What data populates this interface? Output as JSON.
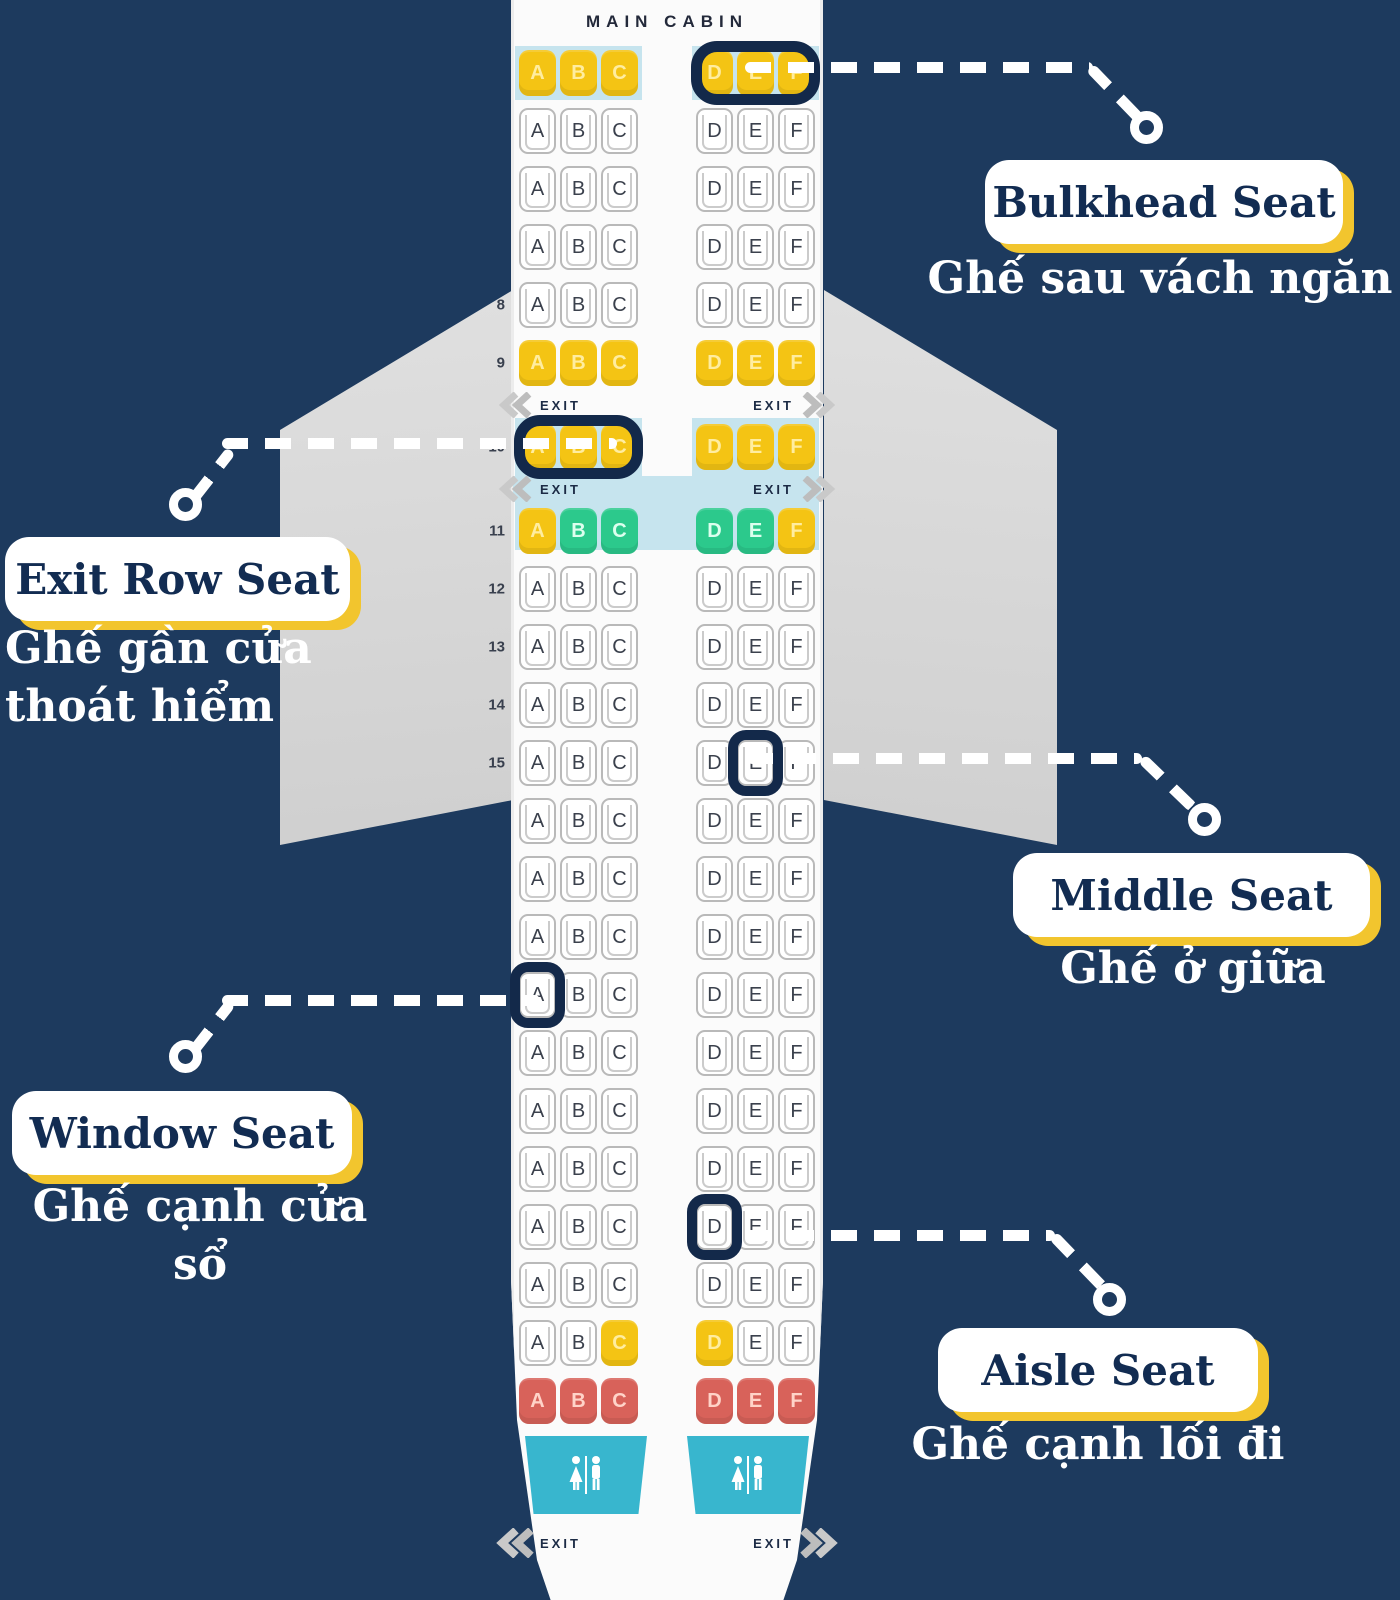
{
  "seatmap": {
    "cabin_label": "MAIN CABIN",
    "exit_label": "EXIT",
    "letters": [
      "A",
      "B",
      "C",
      "D",
      "E",
      "F"
    ],
    "rows": [
      {
        "t": "seats",
        "num": "",
        "c": "yyyyyy",
        "band": "split",
        "ring": "right-group"
      },
      {
        "t": "seats",
        "num": "",
        "c": "wwwwww"
      },
      {
        "t": "seats",
        "num": "",
        "c": "wwwwww"
      },
      {
        "t": "seats",
        "num": "",
        "c": "wwwwww"
      },
      {
        "t": "seats",
        "num": "8",
        "c": "wwwwww"
      },
      {
        "t": "seats",
        "num": "9",
        "c": "yyyyyy"
      },
      {
        "t": "exit"
      },
      {
        "t": "seats",
        "num": "10",
        "c": "yyyyyy",
        "band": "split",
        "ring": "left-group"
      },
      {
        "t": "exit",
        "band": "full"
      },
      {
        "t": "seats",
        "num": "11",
        "c": "yggggy",
        "band": "full"
      },
      {
        "t": "seats",
        "num": "12",
        "c": "wwwwww"
      },
      {
        "t": "seats",
        "num": "13",
        "c": "wwwwww"
      },
      {
        "t": "seats",
        "num": "14",
        "c": "wwwwww"
      },
      {
        "t": "seats",
        "num": "15",
        "c": "wwwwww",
        "ring": 4
      },
      {
        "t": "seats",
        "num": "",
        "c": "wwwwww"
      },
      {
        "t": "seats",
        "num": "",
        "c": "wwwwww"
      },
      {
        "t": "seats",
        "num": "",
        "c": "wwwwww"
      },
      {
        "t": "seats",
        "num": "",
        "c": "wwwwww",
        "ring": 0
      },
      {
        "t": "seats",
        "num": "",
        "c": "wwwwww"
      },
      {
        "t": "seats",
        "num": "",
        "c": "wwwwww"
      },
      {
        "t": "seats",
        "num": "",
        "c": "wwwwww"
      },
      {
        "t": "seats",
        "num": "",
        "c": "wwwwww",
        "ring": 3
      },
      {
        "t": "seats",
        "num": "",
        "c": "wwwwww"
      },
      {
        "t": "seats",
        "num": "",
        "c": "wwyyww"
      },
      {
        "t": "seats",
        "num": "",
        "c": "rrrrrr"
      },
      {
        "t": "lav"
      },
      {
        "t": "exit",
        "bottom": true
      }
    ]
  },
  "callouts": [
    {
      "id": "bulkhead",
      "title": "Bulkhead Seat",
      "subtitle": "Ghế sau vách ngăn"
    },
    {
      "id": "exitrow",
      "title": "Exit Row Seat",
      "subtitle": "Ghế gần cửa thoát hiểm"
    },
    {
      "id": "middle",
      "title": "Middle Seat",
      "subtitle": "Ghế ở giữa"
    },
    {
      "id": "window",
      "title": "Window Seat",
      "subtitle": "Ghế cạnh cửa sổ"
    },
    {
      "id": "aisle",
      "title": "Aisle Seat",
      "subtitle": "Ghế cạnh lối đi"
    }
  ],
  "colors": {
    "background": "#1d3a5e",
    "fuselage": "#fbfbfb",
    "wing": "#d8d8d8",
    "seat_yellow": "#f4c414",
    "seat_green": "#2cc98c",
    "seat_red": "#d8625a",
    "band_blue": "#c6e4ee",
    "lavatory_teal": "#38b6ce",
    "highlight_ring": "#13294a",
    "callout_shadow": "#f2c52e",
    "callout_text": "#122c52"
  },
  "icons": {
    "restroom": "restroom-icon",
    "chevron_left": "chevron-left-icon",
    "chevron_right": "chevron-right-icon"
  }
}
